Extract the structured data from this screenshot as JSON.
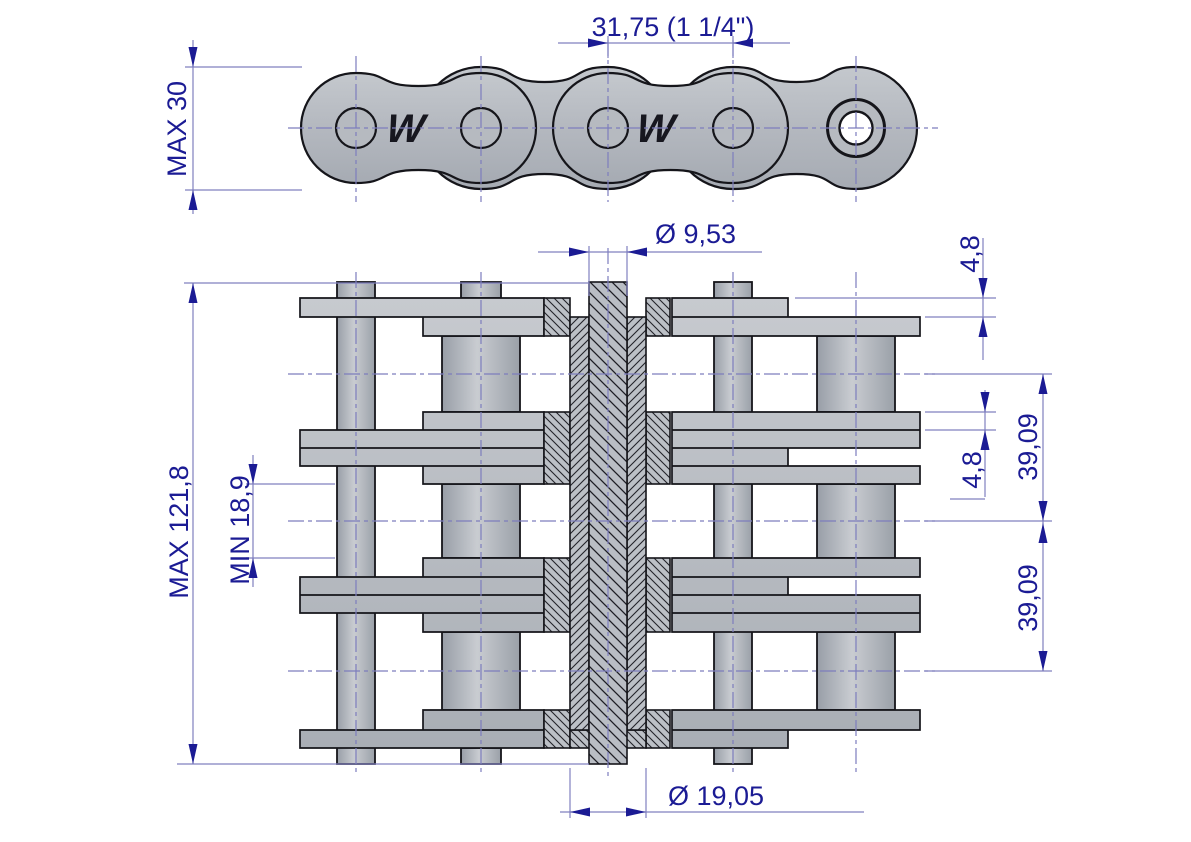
{
  "drawing": {
    "logo": "W",
    "top_view": {
      "pitch": "31,75  (1 1/4\")",
      "plate_height": "MAX 30"
    },
    "section_view": {
      "pin_diameter": "Ø 9,53",
      "plate_thickness_outer": "4,8",
      "plate_thickness_inner": "4,8",
      "strand_spacing_top": "39,09",
      "strand_spacing_bottom": "39,09",
      "overall_width": "MAX 121,8",
      "inner_width": "MIN 18,9",
      "roller_diameter": "Ø 19,05"
    },
    "colors": {
      "dimension_text": "#1b1b94",
      "dimension_line": "#8080bf",
      "centerline": "#7d7dbd",
      "plate_fill": "#b7bbc1",
      "outline": "#15151a",
      "background": "#ffffff"
    }
  }
}
